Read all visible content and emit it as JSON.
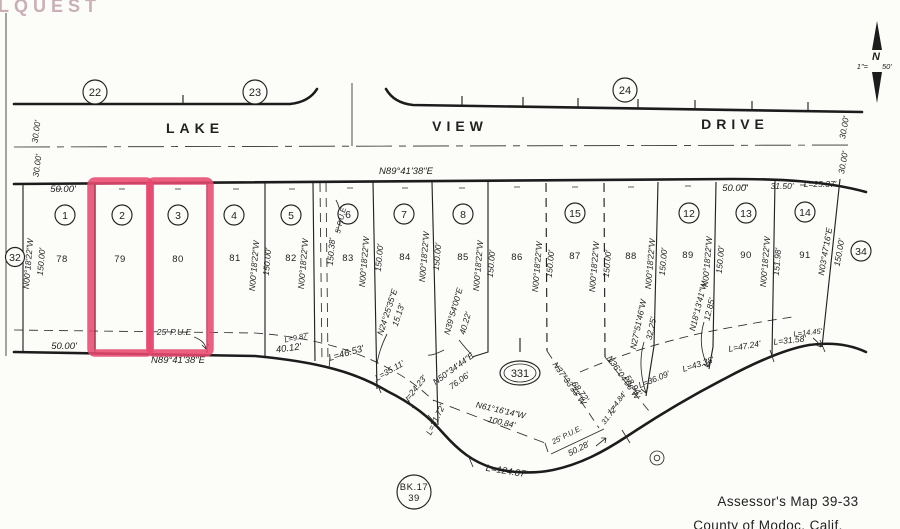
{
  "watermark": "LQUEST",
  "north": {
    "letter": "N",
    "scale_left": "1\"=",
    "scale_right": "50'"
  },
  "street": {
    "lake": "LAKE",
    "view": "VIEW",
    "drive": "DRIVE"
  },
  "blocks": {
    "c22": "22",
    "c23": "23",
    "c24": "24",
    "c32": "32",
    "c34": "34"
  },
  "map_ref": {
    "c331": "331",
    "book_line1": "BK.17",
    "book_line2": "39"
  },
  "lot_numbers": [
    "1",
    "2",
    "3",
    "4",
    "5",
    "6",
    "7",
    "8",
    "15",
    "12",
    "13",
    "14"
  ],
  "parcels": [
    "78",
    "79",
    "80",
    "81",
    "82",
    "83",
    "84",
    "85",
    "86",
    "87",
    "88",
    "89",
    "90",
    "91"
  ],
  "bearings": {
    "n89": "N89°41'38\"E",
    "n00": "N00°18'22\"W",
    "n03": "N03°47'16\"E",
    "n24": "N24°25'35\"E",
    "n39": "N39°54'00\"E",
    "n50": "N50°34'44\"E",
    "n61": "N61°16'14\"W",
    "n37": "N37°33'33\"W",
    "n36": "N36°04'06\"W",
    "n27": "N27°51'46\"W",
    "n18": "N18°13'41\"W"
  },
  "dims": {
    "d30": "30.00'",
    "d50": "50.00'",
    "d150": "150.00'",
    "d150_38": "150.38'",
    "d151_98": "151.98'",
    "d31_50": "31.50'",
    "d40_12": "40.12'",
    "d40_22": "40.22'",
    "d15_13": "15.13'",
    "d76_06": "76.06'",
    "d100_84": "100.84'",
    "d68_72": "68.72'",
    "d58_94": "58.94'",
    "d32_25": "32.25'",
    "d12_85": "12.85'",
    "d50_28": "50.28'",
    "d31_72": "31.72'"
  },
  "curves": {
    "l9_87": "L=9.87'",
    "l25_37": "L=25.37'",
    "l46_53": "L=46.53'",
    "l35_11": "L=35.11'",
    "l24_23": "L=24.23'",
    "l31_72": "L=31.72'",
    "l124_87": "L=124.87'",
    "l36_09": "L=36.09'",
    "l43_38": "L=43.38'",
    "l47_24": "L=47.24'",
    "l31_58": "L=31.58'",
    "l14_45": "L=14.45'",
    "l4_84": "L=4.84'"
  },
  "easements": {
    "pue25": "25' P.U.E",
    "pue25r": "25' P.U.E.",
    "pue5": "5' P.U.E"
  },
  "credits": {
    "line1": "Assessor's Map 39-33",
    "line2": "County of Modoc, Calif."
  },
  "colors": {
    "highlight": "#e8496f",
    "ink": "#1c1c1c",
    "paper": "#fcfcf9",
    "watermark": "#c9afb8"
  }
}
